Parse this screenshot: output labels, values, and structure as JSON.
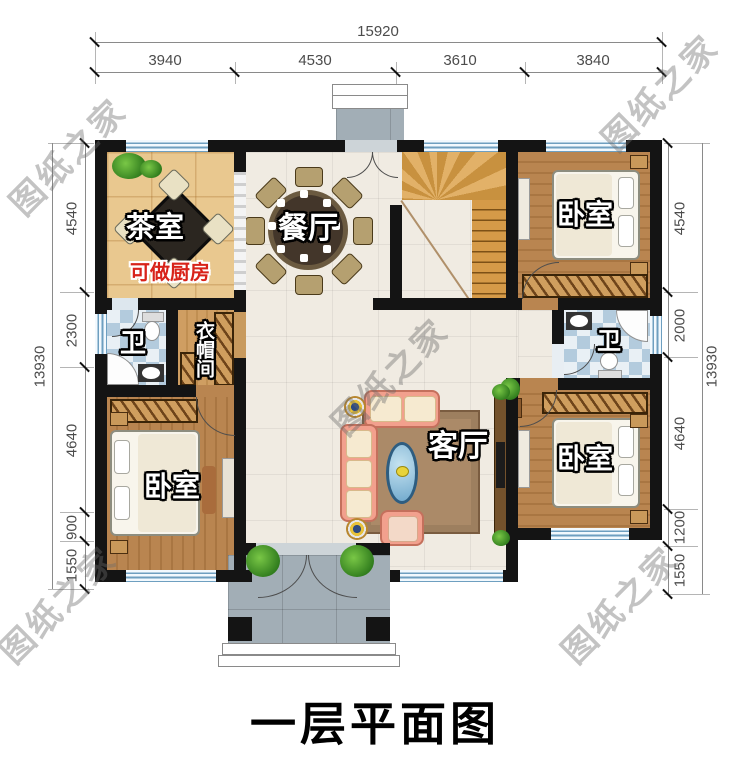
{
  "title": "一层平面图",
  "watermark": "图纸之家",
  "dims": {
    "top": {
      "total": "15920",
      "segments": [
        "3940",
        "4530",
        "3610",
        "3840"
      ]
    },
    "left": {
      "total": "13930",
      "segments": [
        "4540",
        "2300",
        "4640",
        "900",
        "1550"
      ]
    },
    "right": {
      "total": "13930",
      "segments": [
        "4540",
        "2000",
        "4640",
        "1200",
        "1550"
      ]
    }
  },
  "rooms": {
    "tea": {
      "label": "茶室",
      "note": "可做厨房"
    },
    "dining": {
      "label": "餐厅"
    },
    "living": {
      "label": "客厅"
    },
    "bed_tr": {
      "label": "卧室"
    },
    "bed_bl": {
      "label": "卧室"
    },
    "bed_br": {
      "label": "卧室"
    },
    "bath_l": {
      "label": "卫"
    },
    "bath_r": {
      "label": "卫"
    },
    "cloak": {
      "label": "衣帽间"
    }
  },
  "colors": {
    "wall": "#141414",
    "window_blue": "#6e9fc0",
    "tea_floor": "#e9c88f",
    "wood_floor": "#b98550",
    "note_red": "#d8231a",
    "dimension_text": "#4c4c4c",
    "watermark_gray": "#9a9a9a"
  }
}
